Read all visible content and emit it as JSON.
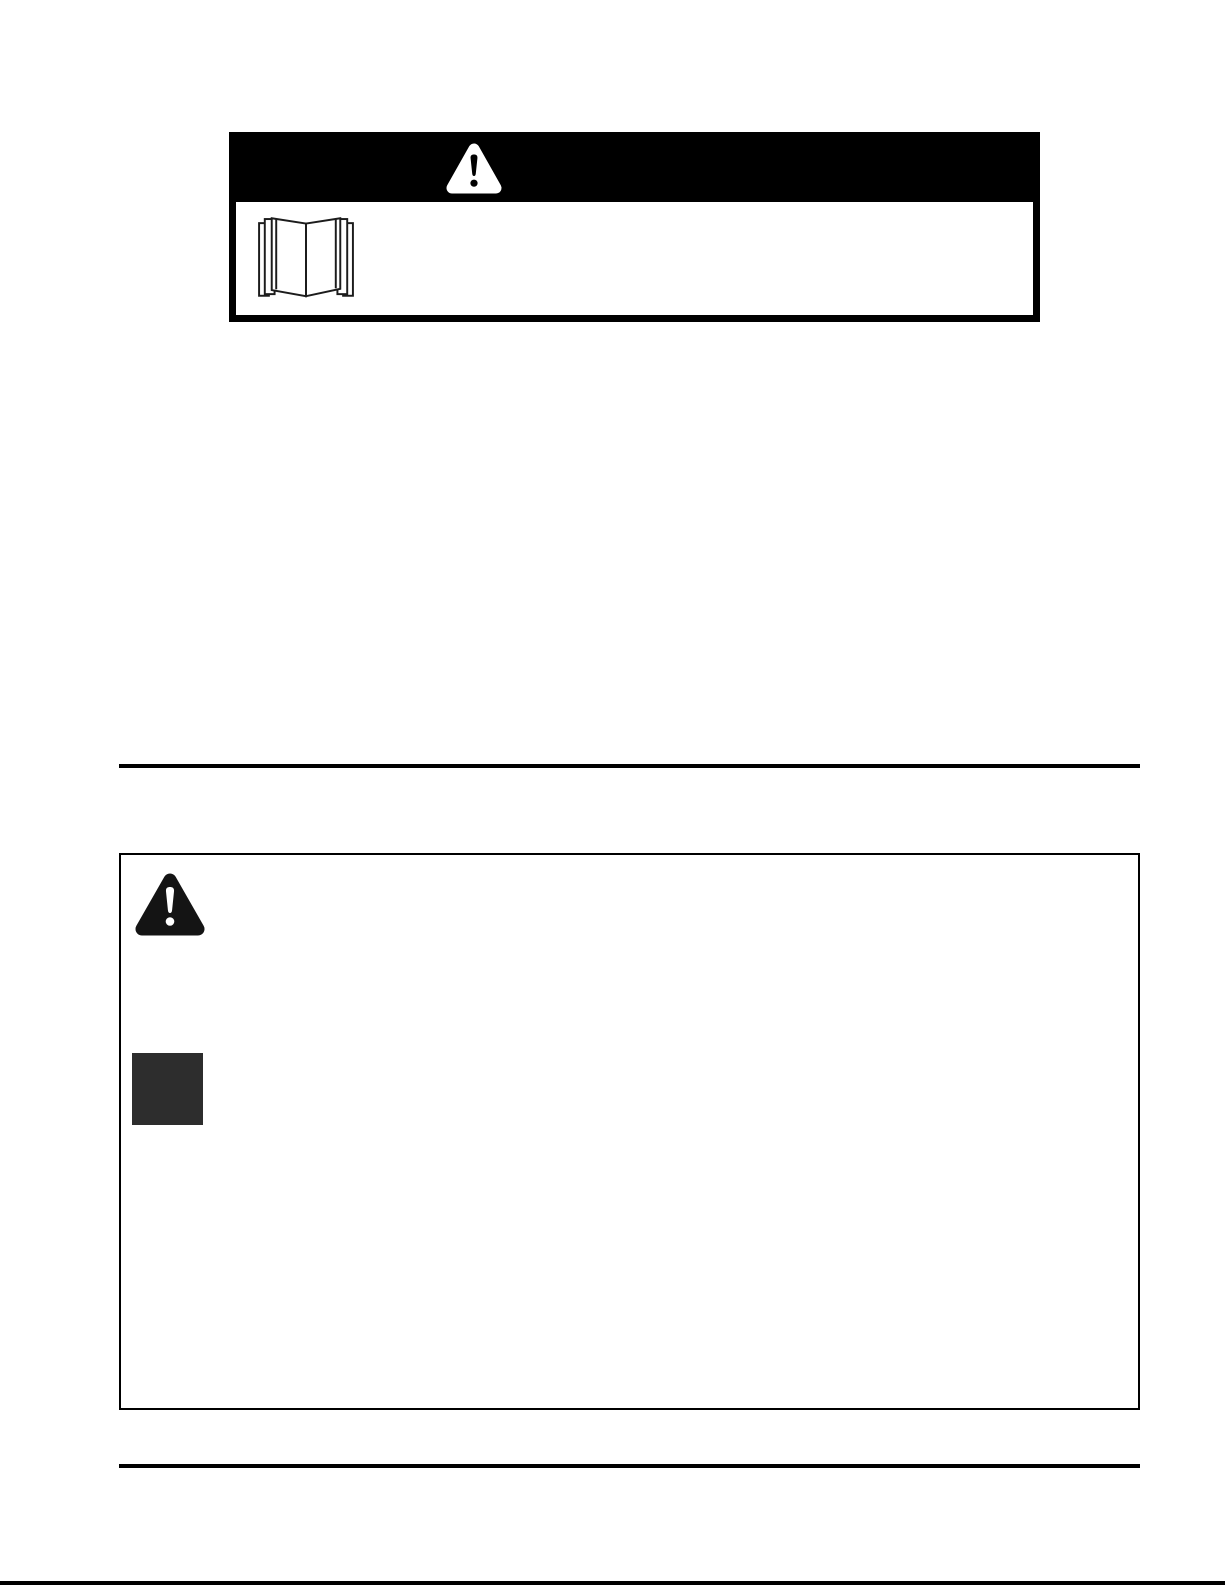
{
  "document": {
    "background_color": "#ffffff",
    "ink_color": "#000000"
  },
  "caution_header_box": {
    "banner_color": "#000000",
    "banner_icon": "alert-triangle-icon",
    "banner_text": "",
    "body_icon": "open-book-icon",
    "body_text": ""
  },
  "warning_box": {
    "alert_icon": "alert-triangle-icon",
    "square_icon": "redacted-square",
    "square_color": "#2d2d2d",
    "body_text": ""
  },
  "rules": {
    "color": "#000000"
  }
}
